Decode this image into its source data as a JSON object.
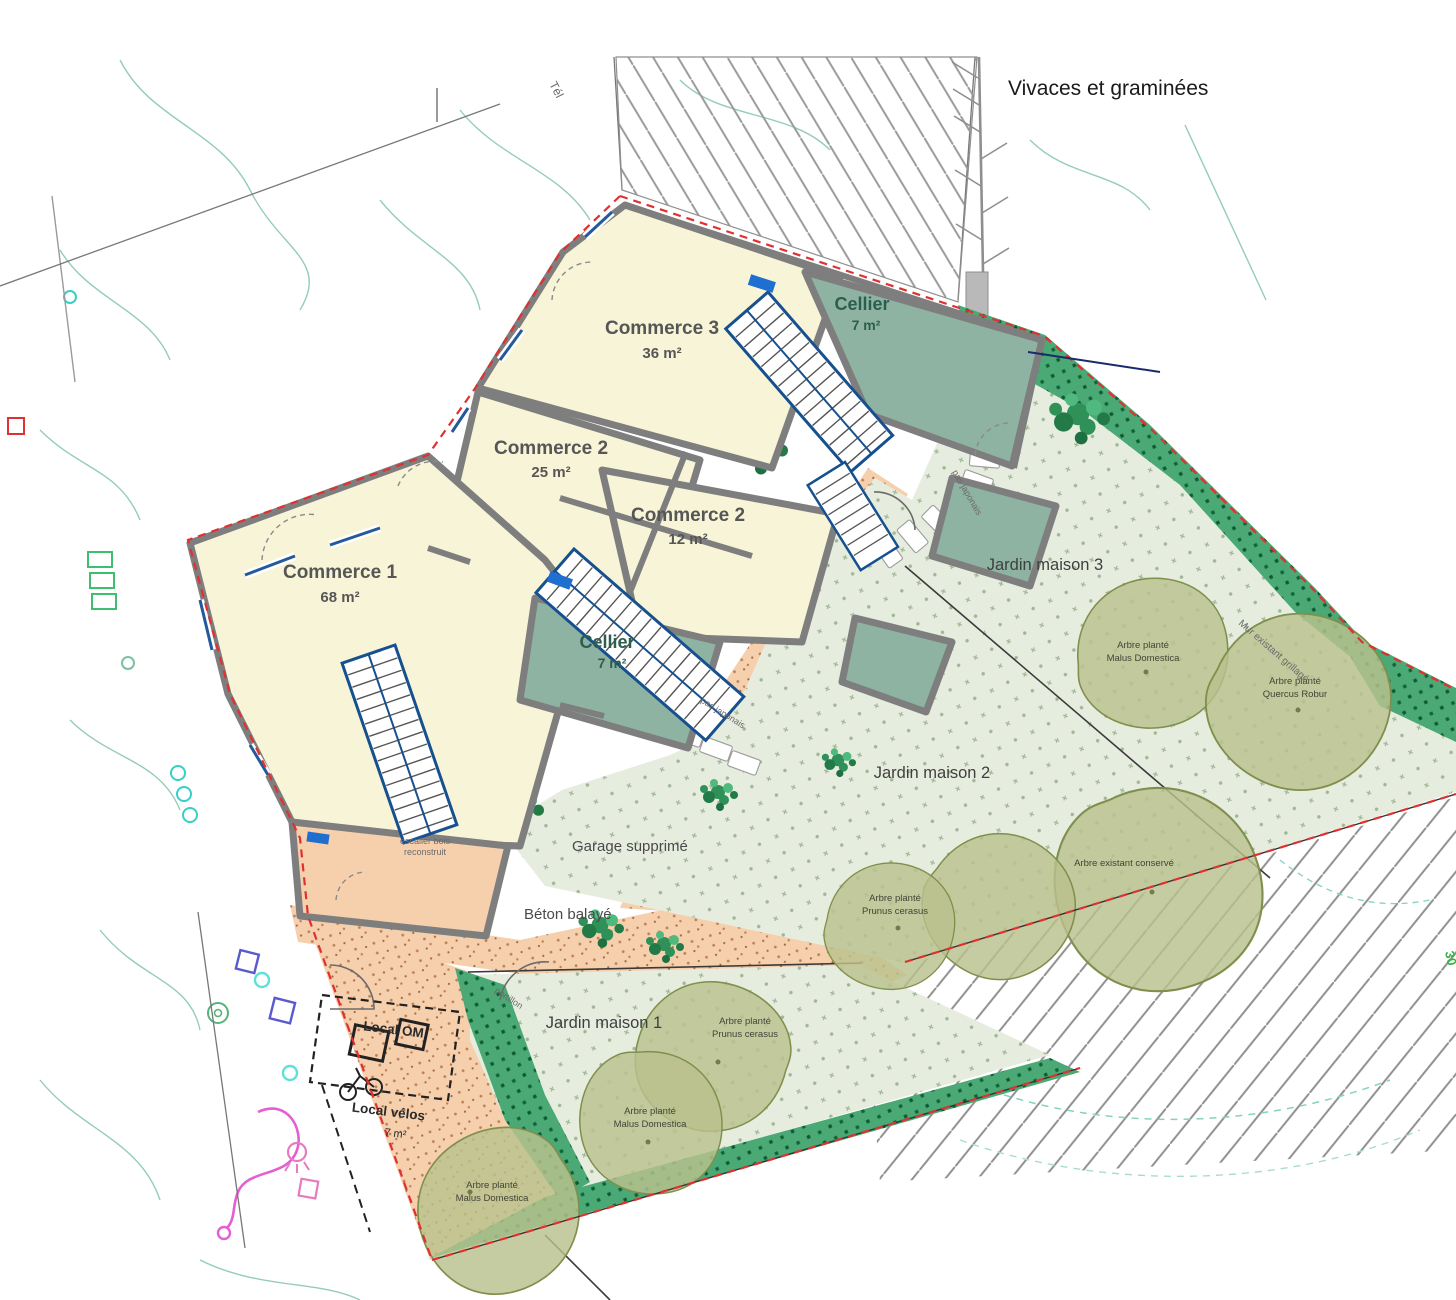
{
  "plan": {
    "vivaces_label": "Vivaces et graminées",
    "tel_label": "Tél",
    "number_30": "30",
    "mur_label": "Mur existant grillagé",
    "pas_japonais_label": "pas japonais",
    "portillon_label": "portillon",
    "garage_label": "Garage supprimé",
    "beton_label": "Béton balayé",
    "escalier_line1": "escalier bois",
    "escalier_line2": "reconstruit"
  },
  "rooms": {
    "commerce3": {
      "name": "Commerce 3",
      "area": "36 m²"
    },
    "commerce2a": {
      "name": "Commerce 2",
      "area": "25 m²"
    },
    "commerce2b": {
      "name": "Commerce 2",
      "area": "12 m²"
    },
    "commerce1": {
      "name": "Commerce 1",
      "area": "68 m²"
    },
    "cellier_haut": {
      "name": "Cellier",
      "area": "7 m²"
    },
    "cellier_bas": {
      "name": "Cellier",
      "area": "7 m²"
    },
    "local_om": {
      "name": "Local OM"
    },
    "local_velos": {
      "name": "Local vélos",
      "area": "7 m²"
    }
  },
  "gardens": [
    {
      "label": "Jardin maison 3"
    },
    {
      "label": "Jardin maison 2"
    },
    {
      "label": "Jardin maison 1"
    }
  ],
  "trees": [
    {
      "line1": "Arbre planté",
      "line2": "Malus Domestica"
    },
    {
      "line1": "Arbre planté",
      "line2": "Quercus Robur"
    },
    {
      "line1": "Arbre existant conservé",
      "line2": ""
    },
    {
      "line1": "Arbre planté",
      "line2": "Prunus cerasus"
    },
    {
      "line1": "Arbre planté",
      "line2": "Prunus cerasus"
    },
    {
      "line1": "Arbre planté",
      "line2": "Malus Domestica"
    },
    {
      "line1": "Arbre planté",
      "line2": "Malus Domestica"
    }
  ],
  "colors": {
    "room_yellow": "#f8f4d7",
    "cellier_green": "#8fb3a3",
    "salmon": "#f6cfad",
    "garden_light": "#e6eddf",
    "hedge_green": "#4aa974",
    "tree_olive": "#b9c18d",
    "boundary_red": "#e03131",
    "wall_gray": "#7e7e7e",
    "stair_blue": "#16508f"
  }
}
